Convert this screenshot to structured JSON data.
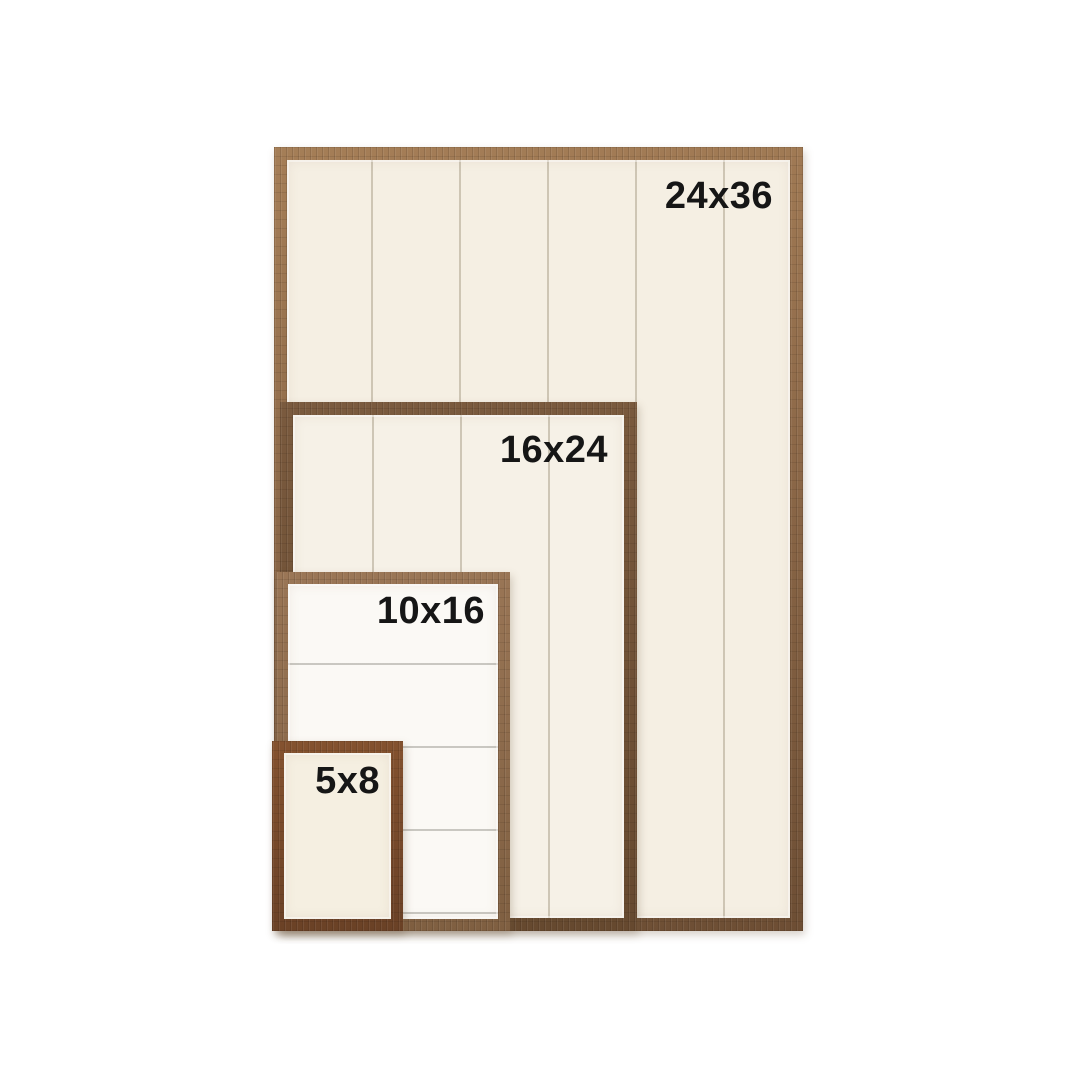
{
  "background_color": "#ffffff",
  "label_text_color": "#161616",
  "frames": [
    {
      "label": "24x36",
      "wood_color": "#8c6848",
      "interior_color": "#f5efe3",
      "plank_direction": "vertical"
    },
    {
      "label": "16x24",
      "wood_color": "#66492f",
      "interior_color": "#f6f1e7",
      "plank_direction": "vertical"
    },
    {
      "label": "10x16",
      "wood_color": "#8a684a",
      "interior_color": "#fbf9f5",
      "plank_direction": "horizontal"
    },
    {
      "label": "5x8",
      "wood_color": "#6f4428",
      "interior_color": "#f5efe1",
      "plank_direction": "none"
    }
  ]
}
